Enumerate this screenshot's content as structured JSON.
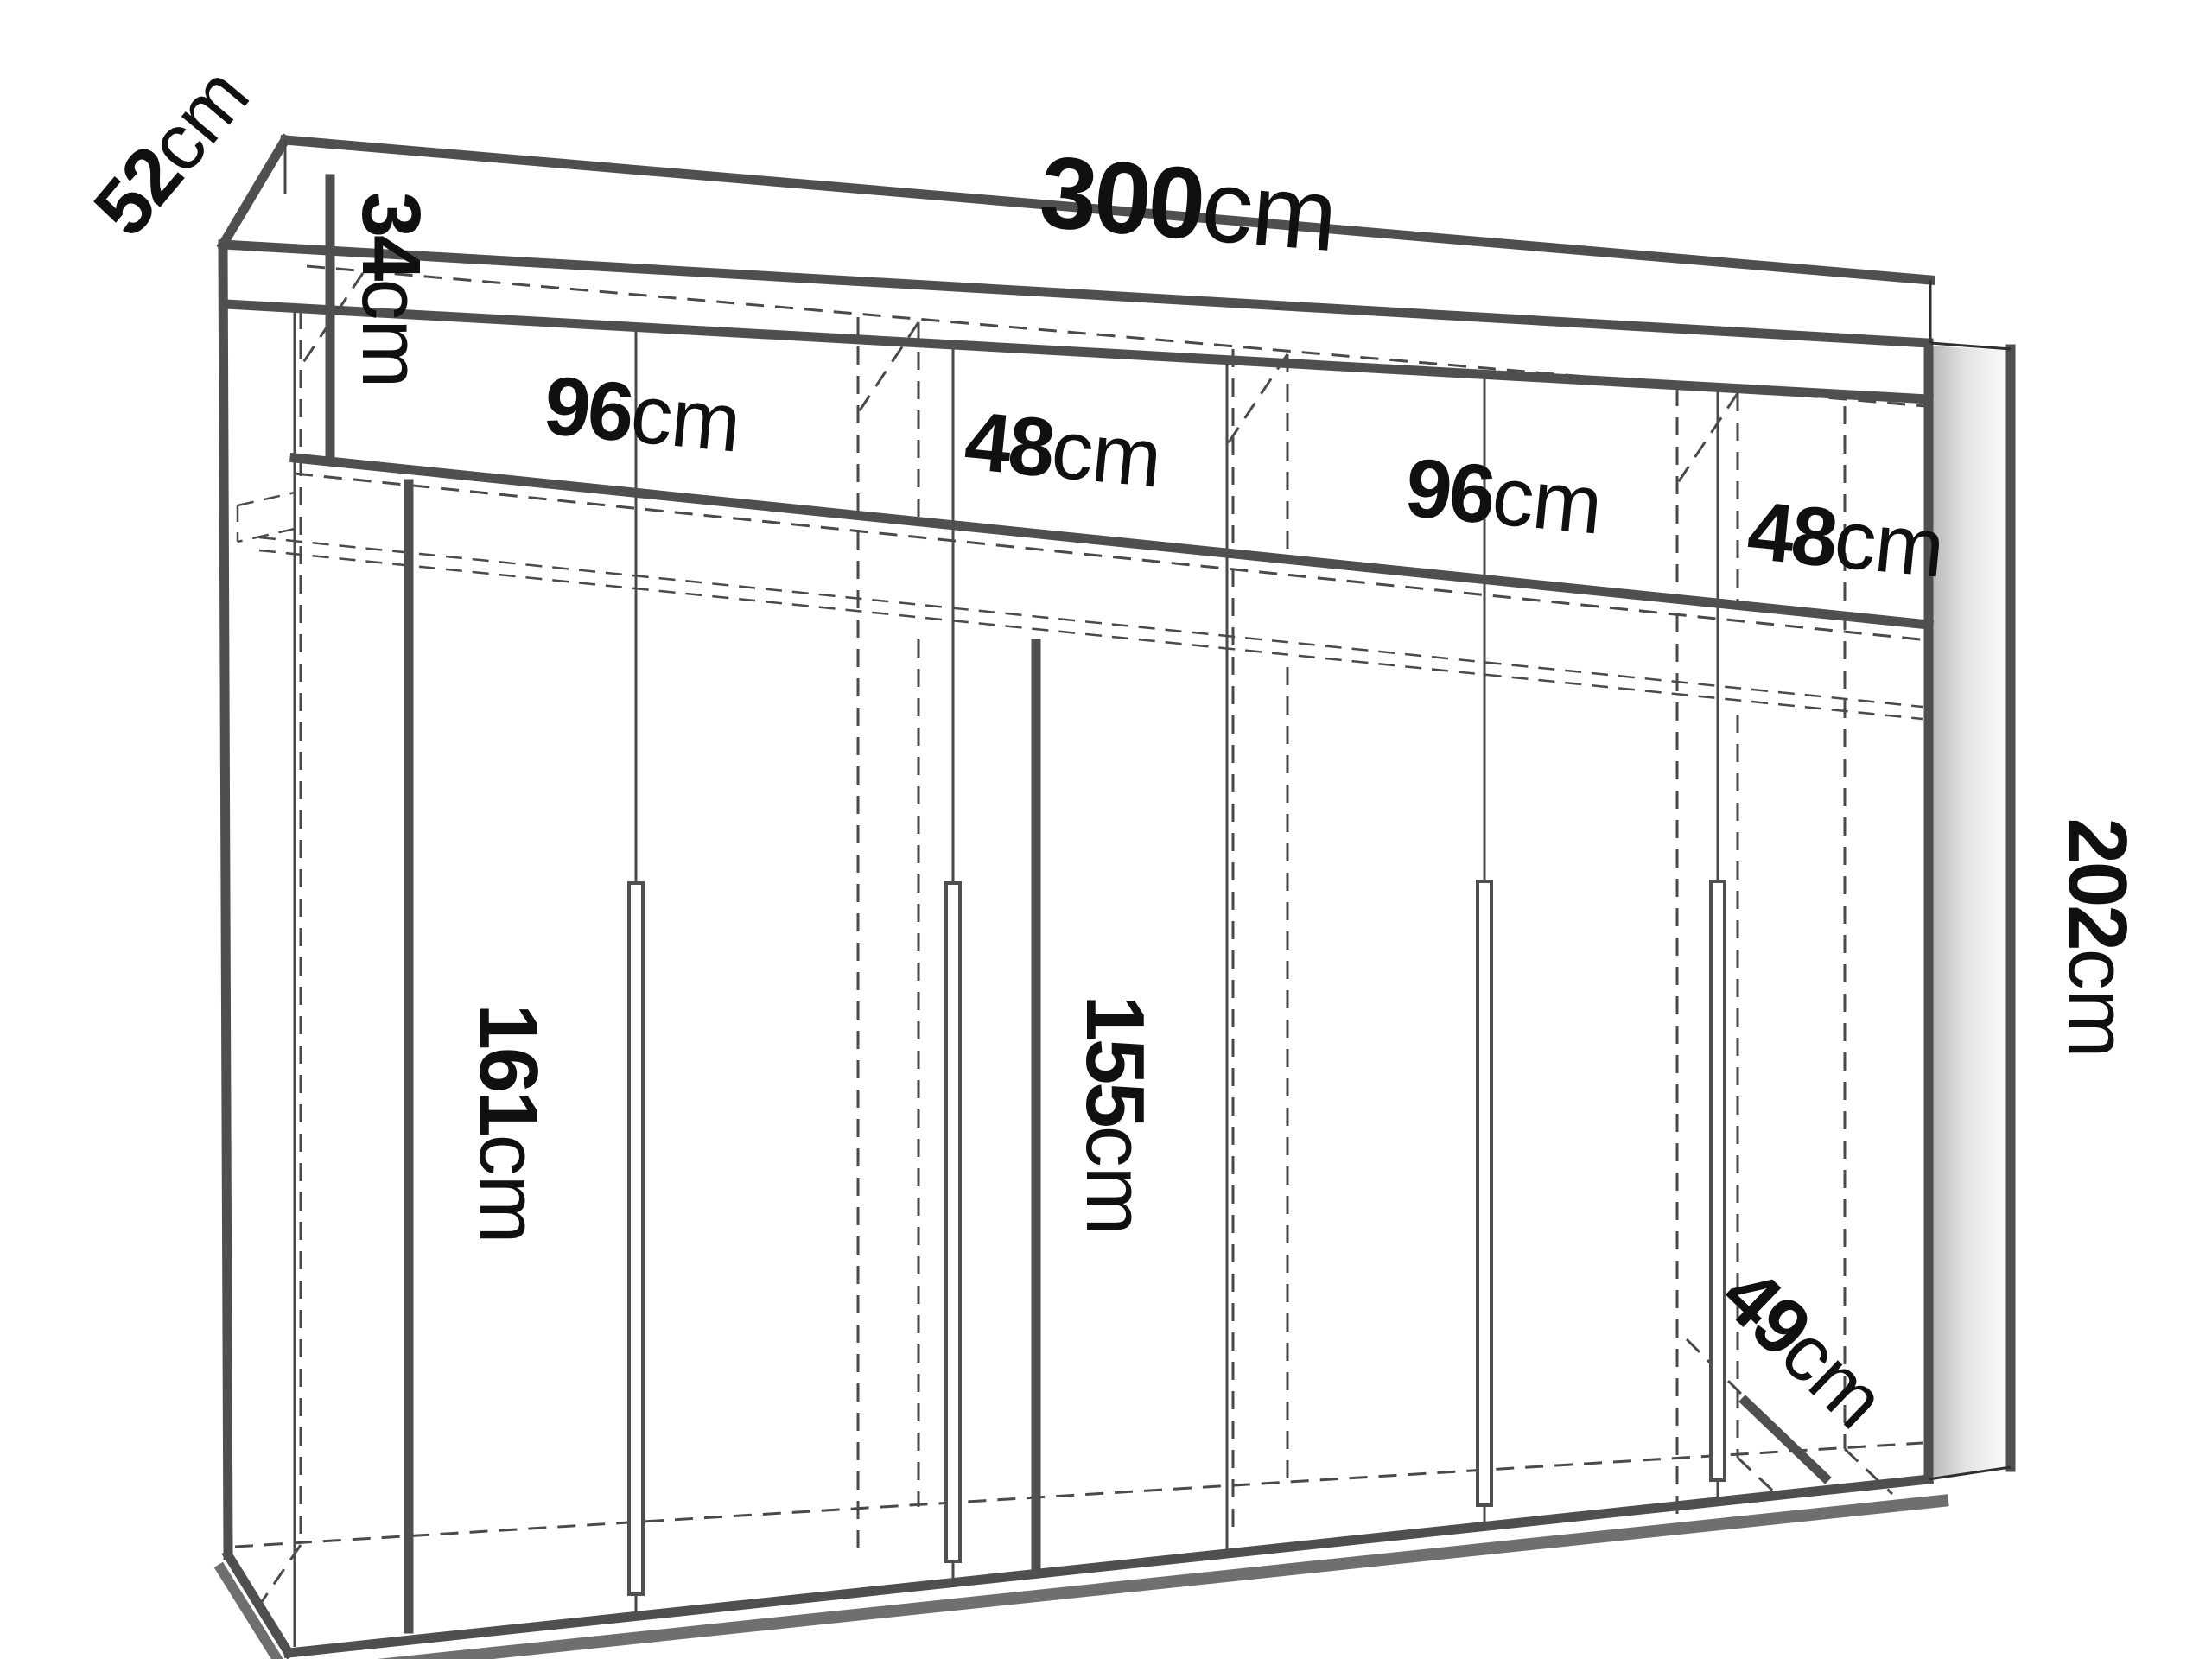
{
  "title": "wardrobe-dimension-diagram",
  "unit": "cm",
  "colors": {
    "outline": "#4f4f4f",
    "hidden_edges": "#4a4a4a",
    "text": "#101010",
    "shadow": "#6f6f6f",
    "background": "#ffffff"
  },
  "dimensions": {
    "depth_top": {
      "value": "52",
      "unit": "cm",
      "meaning": "top depth"
    },
    "width_total": {
      "value": "300",
      "unit": "cm",
      "meaning": "total width"
    },
    "height_top_section": {
      "value": "34",
      "unit": "cm",
      "meaning": "upper shelf section height"
    },
    "width_section_1": {
      "value": "96",
      "unit": "cm",
      "meaning": "interior section width 1"
    },
    "width_section_2": {
      "value": "48",
      "unit": "cm",
      "meaning": "interior section width 2"
    },
    "width_section_3": {
      "value": "96",
      "unit": "cm",
      "meaning": "interior section width 3"
    },
    "width_section_4": {
      "value": "48",
      "unit": "cm",
      "meaning": "interior section width 4"
    },
    "height_interior_left": {
      "value": "161",
      "unit": "cm",
      "meaning": "hanging space height left"
    },
    "height_interior_mid": {
      "value": "155",
      "unit": "cm",
      "meaning": "hanging space height middle"
    },
    "height_total": {
      "value": "202",
      "unit": "cm",
      "meaning": "total height"
    },
    "depth_bottom": {
      "value": "49",
      "unit": "cm",
      "meaning": "interior floor depth"
    }
  }
}
